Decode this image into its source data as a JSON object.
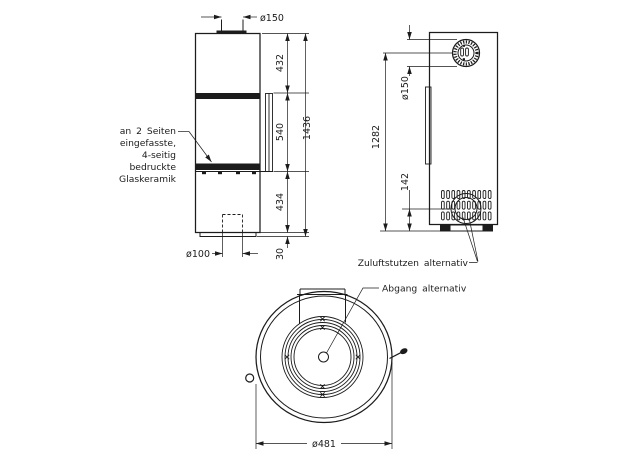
{
  "front": {
    "outlet_dim": "ø150",
    "upper": "432",
    "glass": "540",
    "lower": "434",
    "plinth": "30",
    "total": "1436",
    "inlet_dim": "ø100",
    "note_lines": [
      "an 2 Seiten",
      "eingefasste,",
      "4-seitig",
      "bedruckte",
      "Glaskeramik"
    ]
  },
  "side": {
    "flue_dim": "ø150",
    "flue_center_height": "1282",
    "inlet_center_height": "142",
    "inlet_label": "Zuluftstutzen alternativ"
  },
  "plan": {
    "diameter": "ø481",
    "outlet_label": "Abgang alternativ"
  },
  "colors": {
    "line": "#1c1c1c",
    "background": "#ffffff"
  }
}
